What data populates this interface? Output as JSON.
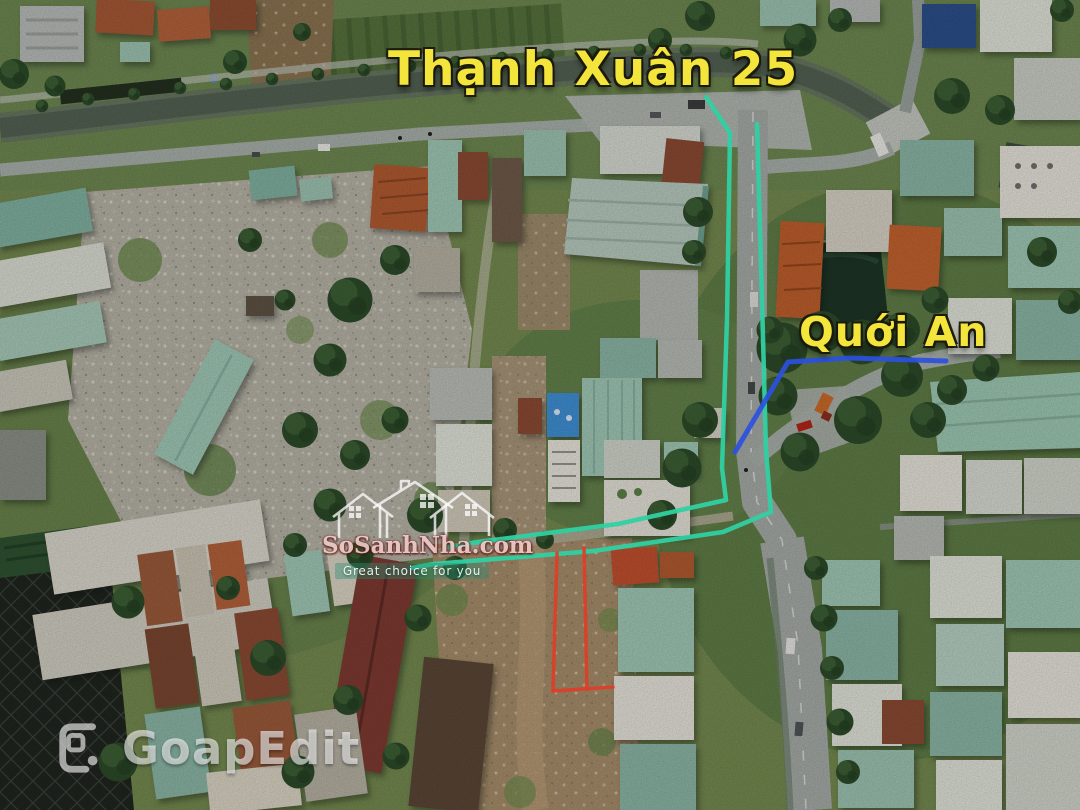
{
  "labels": {
    "main_street": "Thạnh Xuân 25",
    "side_street": "Quới An"
  },
  "watermarks": {
    "site": {
      "brand": "SoSanhNha.com",
      "tagline": "Great choice for you"
    },
    "editor": {
      "name": "GoapEdit"
    }
  },
  "colors": {
    "route_highlight": "#2fd0a2",
    "street_marker": "#2b50e0",
    "plot_outline": "#e03c25",
    "street_label": "#f4e53c"
  }
}
